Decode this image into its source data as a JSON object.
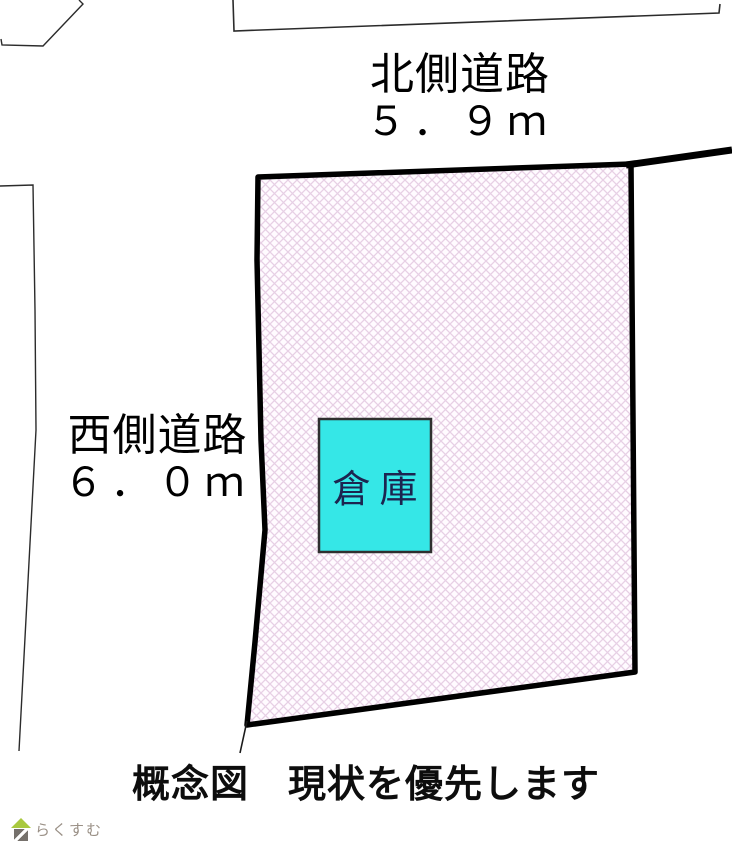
{
  "diagram": {
    "title_hint": "land plot conceptual drawing",
    "north_road": {
      "label": "北側道路",
      "width": "５．９ｍ"
    },
    "west_road": {
      "label": "西側道路",
      "width": "６．０ｍ"
    },
    "warehouse_label": "倉庫",
    "caption": "概念図　現状を優先します"
  },
  "logo": {
    "text": "らくすむ",
    "icon": "house-logo-icon"
  },
  "colors": {
    "parcel_fill_bg": "#fffbff",
    "parcel_hatch_line": "#e7d0e5",
    "parcel_border": "#000000",
    "neighbor_line": "#2b2b2b",
    "warehouse_fill": "#35e7e7",
    "warehouse_border": "#2f2f2f",
    "warehouse_text": "#1c2550",
    "caption_text": "#0d0d0d",
    "logo_roof_green": "#a9c93f",
    "logo_text_gray": "#9a9086"
  }
}
